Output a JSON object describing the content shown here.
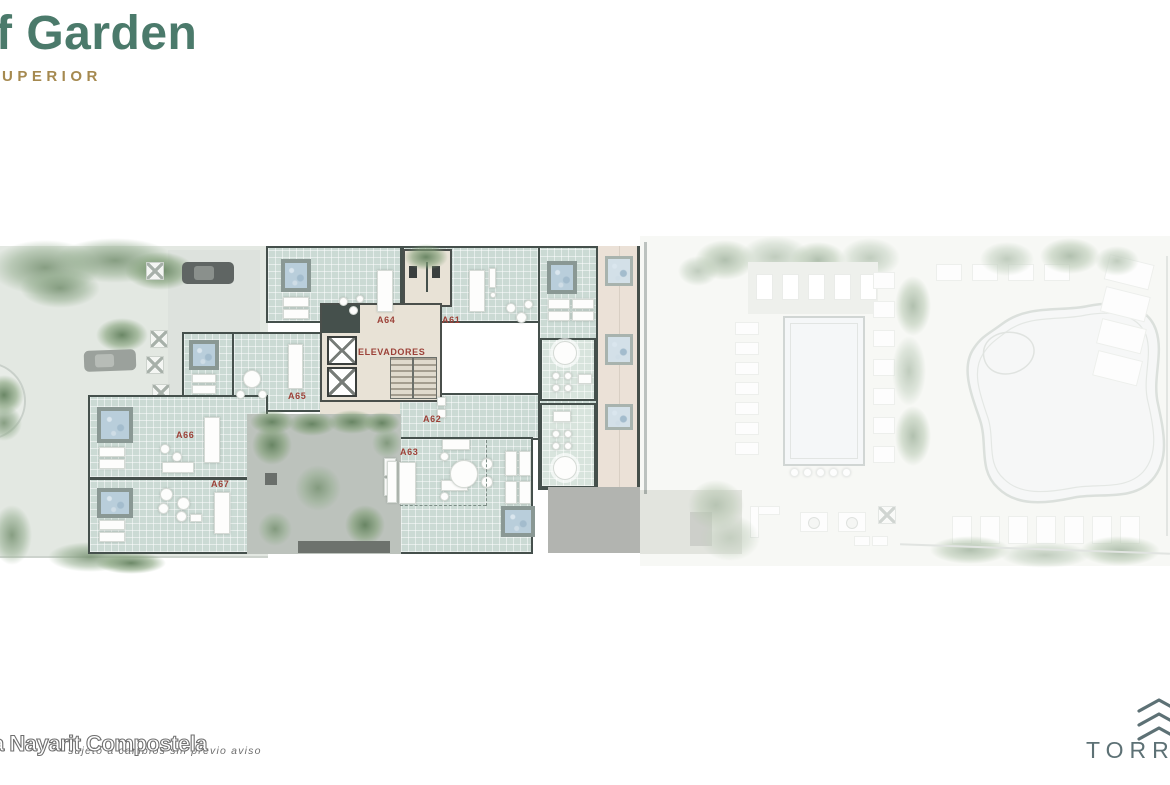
{
  "header": {
    "title": "f Garden",
    "subtitle": "UPERIOR"
  },
  "plan": {
    "units": [
      {
        "label": "A64"
      },
      {
        "label": "A61"
      },
      {
        "label": "A65"
      },
      {
        "label": "A66"
      },
      {
        "label": "A67"
      },
      {
        "label": "A62"
      },
      {
        "label": "A63"
      }
    ],
    "core_label": "ELEVADORES"
  },
  "footer": {
    "watermark_large": "a Nayarit Compostela",
    "watermark_small": "sujeto a cambios sin previo aviso",
    "logo_text": "TORRE"
  },
  "colors": {
    "title_green": "#4b7a6b",
    "subtitle_gold": "#a5894f",
    "unit_label_red": "#9c4138",
    "deck_teal": "#cbdad4",
    "wall_dark": "#45504c",
    "water_blue": "#b9cedb",
    "courtyard_gray": "#bcc2bc",
    "logo_slate": "#5d7175"
  }
}
